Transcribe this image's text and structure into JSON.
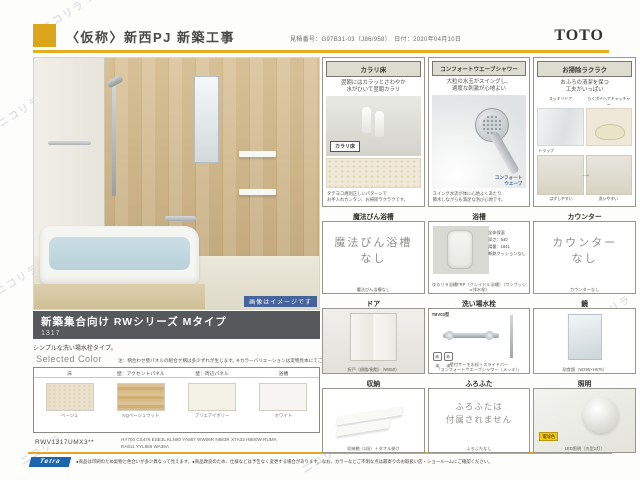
{
  "header": {
    "project_title": "〈仮称〉新西PJ 新築工事",
    "quote_info": "見積番号：G97B31-03（J86/958）　日付：2020年04月10日",
    "brand_logo": "TOTO"
  },
  "photo": {
    "image_note": "画像はイメージです"
  },
  "product": {
    "series_title": "新築集合向け RWシリーズ  Mタイプ",
    "size_code": "1317",
    "tagline": "シンプルな洗い場水栓タイプ。"
  },
  "selected_color": {
    "label": "Selected Color",
    "note_left": "注：柄合わせ壁パネルの組合せ柄は多少ずれが生じます。",
    "note_right": "※カラーバリエーションは実物見本にてご確認ください",
    "columns": [
      "床",
      "壁：アクセントパネル",
      "壁：周辺パネル",
      "浴槽"
    ],
    "swatches": [
      {
        "name": "ベージュ"
      },
      {
        "name": "NQベージュウッド"
      },
      {
        "name": "プリエアイボリー"
      },
      {
        "name": "ホワイト"
      }
    ],
    "model_code": "RWV1317UMX3**",
    "codes_line1": "HY700  CS476  ESE3L  KLN80  YA867  WW06R  N883R  X7A33  HB00W  RUMA",
    "codes_line2": "RA611  YYL986  WA39A"
  },
  "features": {
    "karari": {
      "header": "カラリ床",
      "copy": "翌朝にはカラッとさわやか\n水がひいて翌朝カラリ",
      "badge": "カラリ床",
      "foot": "タテヨコ規則正しいパターンで\nお手入れカンタン、お掃除ラクラクです。"
    },
    "shower": {
      "header": "コンフォートウエーブシャワー",
      "copy": "大粒の水玉がスイングし、\n適度な刺激が心地よい",
      "badge": "コンフォート\nウエーブ",
      "foot": "スイング水流が体に心地よくあたり、\n節水しながらも満足な浴び心地です。"
    },
    "cleaning": {
      "header": "お掃除ラクラク",
      "copy": "おふろの清潔を保つ\n工夫がいっぱい",
      "label1": "スッキリドア",
      "label2": "らくポイヘアキャッチャー",
      "label3": "トラップ",
      "caption1": "はずしやすい",
      "caption2": "洗いやすい"
    },
    "mahoubin": {
      "title": "魔法びん浴槽",
      "body": "魔法びん浴槽\nなし",
      "caption": "魔法びん浴槽なし"
    },
    "bathtub": {
      "title": "浴槽",
      "specs": "全体保温\n深さ：540\n湯量：184L\n断熱クッションなし",
      "caption": "ゆるリラ浴槽FRP（クレイドル浴槽）（ワンプッシュ排水栓）"
    },
    "counter": {
      "title": "カウンター",
      "body": "カウンター\nなし",
      "caption": "カウンターなし"
    },
    "door": {
      "title": "ドア",
      "caption": "折戸（樹脂/樹脂）（W650）"
    },
    "faucet": {
      "title": "洗い場水栓",
      "model": "TBV03型",
      "icon1": "節湯",
      "icon2": "節湯",
      "caption": "壁付サーモ水栓＋スライドバー\n「コンフォートウエーブシャワー（メッキ）」"
    },
    "mirror": {
      "title": "鏡",
      "caption": "耐食鏡（W295×H675）"
    },
    "storage": {
      "title": "収納",
      "caption": "収納棚（1段）＋タオル掛け"
    },
    "lid": {
      "title": "ふろふた",
      "body": "ふろふたは\n付属されません",
      "caption": "ふろふたなし"
    },
    "light": {
      "title": "照明",
      "badge": "電球色",
      "caption": "LED照明（丸型1灯）"
    }
  },
  "footer": {
    "logo": "Tetra",
    "disclaimer": "●商品は印刷のため実物と色合いが多少異なって見えます。●商品改良のため、仕様などは予告なく変更する場合があります。なお、カラーなどご不明な点は最寄りのお取扱い店・ショールームにご確認ください。"
  },
  "watermark": "ニコリラ→"
}
